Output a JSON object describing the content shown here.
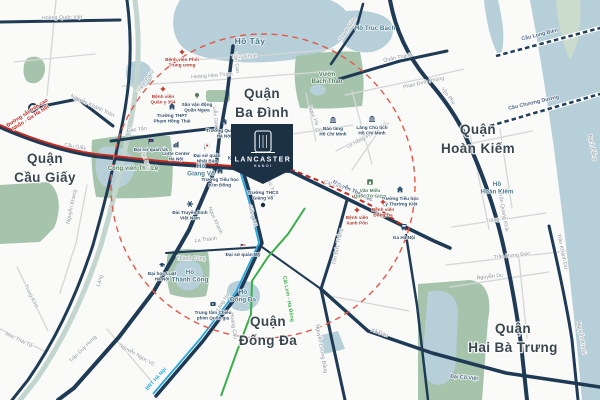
{
  "marker": {
    "title": "LANCASTER",
    "subtitle": "HANOI"
  },
  "colors": {
    "road": "#1e3a55",
    "road_minor": "#d4d7d7",
    "water": "#b6cfd8",
    "park": "#a6c4ac",
    "district_label": "#39474f",
    "metro3": "#c2281e",
    "brt": "#2aa7dd",
    "metro2a": "#3aae49",
    "ring": "#e4584a"
  },
  "districts": [
    {
      "name": "Quận Cầu Giấy",
      "lines": [
        "Quận",
        "Cầu Giấy"
      ],
      "x": 45,
      "y": 163
    },
    {
      "name": "Quận Ba Đình",
      "lines": [
        "Quận",
        "Ba Đình"
      ],
      "x": 262,
      "y": 98
    },
    {
      "name": "Quận Hoàn Kiếm",
      "lines": [
        "Quận",
        "Hoàn Kiếm"
      ],
      "x": 478,
      "y": 134
    },
    {
      "name": "Quận Đống Đa",
      "lines": [
        "Quận",
        "Đống Đa"
      ],
      "x": 268,
      "y": 326
    },
    {
      "name": "Quận Hai Bà Trưng",
      "lines": [
        "Quận",
        "Hai Bà Trưng"
      ],
      "x": 513,
      "y": 333
    }
  ],
  "water_labels": [
    {
      "name": "Hồ Tây",
      "x": 250,
      "y": 44,
      "big": true
    },
    {
      "name": "Hồ Trúc Bạch",
      "x": 375,
      "y": 30
    },
    {
      "name": "Hồ Hoàn Kiếm",
      "lines": [
        "Hồ",
        "Hoàn Kiếm"
      ],
      "x": 497,
      "y": 186
    },
    {
      "name": "Hồ Giảng Võ",
      "lines": [
        "Hồ",
        "Giảng Võ"
      ],
      "x": 201,
      "y": 168
    },
    {
      "name": "Hồ Thành Công",
      "lines": [
        "Hồ",
        "Thành Công"
      ],
      "x": 190,
      "y": 274
    },
    {
      "name": "Hồ Đống Đa",
      "lines": [
        "Hồ",
        "Đống Đa"
      ],
      "x": 243,
      "y": 294
    }
  ],
  "park_labels": [
    {
      "name": "Vườn Bách Thảo",
      "lines": [
        "Vườn",
        "Bách Thảo"
      ],
      "x": 327,
      "y": 76
    },
    {
      "name": "Công viên Thủ Lệ",
      "x": 133,
      "y": 170
    }
  ],
  "streets": [
    {
      "name": "Hoàng Quốc Việt",
      "x": 62,
      "y": 19,
      "rot": -1
    },
    {
      "name": "Nguyễn Khánh Toàn",
      "x": 92,
      "y": 107,
      "rot": 25
    },
    {
      "name": "Cầu Giấy",
      "x": 75,
      "y": 148,
      "rot": 10
    },
    {
      "name": "Đào Tấn",
      "x": 137,
      "y": 131,
      "rot": -7
    },
    {
      "name": "Nguyễn Khang",
      "x": 73,
      "y": 207,
      "rot": -78
    },
    {
      "name": "Láng",
      "x": 101,
      "y": 281,
      "rot": -72
    },
    {
      "name": "Trần Duy Hưng",
      "x": 84,
      "y": 350,
      "rot": -45
    },
    {
      "name": "Nguyễn Ngọc Vũ",
      "x": 136,
      "y": 356,
      "rot": 30
    },
    {
      "name": "Trung Kính",
      "x": 30,
      "y": 297,
      "rot": 64
    },
    {
      "name": "Mạc Thái Tổ",
      "x": 18,
      "y": 341,
      "rot": 26
    },
    {
      "name": "Vành Đai 2",
      "x": 147,
      "y": 82,
      "rot": -55
    },
    {
      "name": "Thụy Khuê",
      "x": 244,
      "y": 58,
      "rot": -3
    },
    {
      "name": "Hoàng Hoa Thám",
      "x": 212,
      "y": 77,
      "rot": -4
    },
    {
      "name": "Văn Cao",
      "x": 235,
      "y": 63,
      "rot": 82
    },
    {
      "name": "Liễu Giai",
      "x": 214,
      "y": 117,
      "rot": 84
    },
    {
      "name": "Ngọc Hà",
      "x": 312,
      "y": 116,
      "rot": 68
    },
    {
      "name": "Đội Cấn",
      "x": 325,
      "y": 131,
      "rot": -7
    },
    {
      "name": "Lê Hồng Phong",
      "x": 364,
      "y": 140,
      "rot": -27
    },
    {
      "name": "Thanh Niên",
      "x": 349,
      "y": 30,
      "rot": -56
    },
    {
      "name": "Quán Thánh",
      "x": 398,
      "y": 59,
      "rot": -11
    },
    {
      "name": "Phan Đình Phùng",
      "x": 424,
      "y": 84,
      "rot": -13
    },
    {
      "name": "Yên Phụ",
      "x": 447,
      "y": 97,
      "rot": 52
    },
    {
      "name": "Kim Mã",
      "x": 237,
      "y": 160,
      "rot": 2,
      "tone": "navy"
    },
    {
      "name": "Núi Trúc",
      "x": 270,
      "y": 188,
      "rot": 74
    },
    {
      "name": "Ngọc Khánh",
      "x": 214,
      "y": 221,
      "rot": 66
    },
    {
      "name": "Vạn Bảo",
      "x": 144,
      "y": 160,
      "rot": 74
    },
    {
      "name": "Giảng Võ",
      "x": 251,
      "y": 216,
      "rot": 76
    },
    {
      "name": "Láng Hạ",
      "x": 224,
      "y": 303,
      "rot": -58
    },
    {
      "name": "La Thành",
      "x": 206,
      "y": 241,
      "rot": -6
    },
    {
      "name": "Thành Công",
      "x": 191,
      "y": 260,
      "rot": 0
    },
    {
      "name": "Hoàng Cầu",
      "x": 232,
      "y": 326,
      "rot": 82
    },
    {
      "name": "Nguyễn Thái Học",
      "x": 352,
      "y": 192,
      "rot": 25,
      "tone": "navy"
    },
    {
      "name": "Cát Linh",
      "x": 333,
      "y": 186,
      "rot": 18
    },
    {
      "name": "Tôn Đức Thắng",
      "x": 339,
      "y": 247,
      "rot": -78
    },
    {
      "name": "Nguyễn Lương Bằng",
      "x": 320,
      "y": 349,
      "rot": 80
    },
    {
      "name": "Xã Đàn",
      "x": 379,
      "y": 334,
      "rot": 20
    },
    {
      "name": "Đại Cồ Việt",
      "x": 464,
      "y": 379,
      "rot": 5,
      "tone": "navy"
    },
    {
      "name": "Tràng Thi",
      "x": 497,
      "y": 221,
      "rot": -8
    },
    {
      "name": "Trần Hưng Đạo",
      "x": 512,
      "y": 257,
      "rot": -6
    },
    {
      "name": "Nguyễn Du",
      "x": 490,
      "y": 278,
      "rot": -6
    },
    {
      "name": "Trần Quang Khải",
      "x": 502,
      "y": 212,
      "rot": 80
    },
    {
      "name": "Trần Khánh Dư",
      "x": 561,
      "y": 252,
      "rot": 78
    },
    {
      "name": "Nguyễn Khoái",
      "x": 580,
      "y": 338,
      "rot": 80
    },
    {
      "name": "Bạch Đằng",
      "x": 591,
      "y": 148,
      "rot": 78
    }
  ],
  "bridges": [
    {
      "name": "Cầu Long Biên",
      "x": 540,
      "y": 36,
      "rot": -14
    },
    {
      "name": "Cầu Chương Dương",
      "x": 534,
      "y": 104,
      "rot": -13
    }
  ],
  "transit": {
    "metro_line_3": {
      "name": "Đường sắt trên cao Nhổn - Ga Hà Nội",
      "color": "#c2281e",
      "label": {
        "lines": [
          "Đường sắt trên cao",
          "Nhổn - Ga Hà Nội"
        ],
        "x": 28,
        "y": 114,
        "rot": -33
      }
    },
    "brt": {
      "name": "BRT Hà Nội",
      "color": "#2aa7dd",
      "label": {
        "x": 157,
        "y": 380,
        "rot": -48
      }
    },
    "metro_line_2a": {
      "name": "Cát Linh - Hà Đông",
      "color": "#3aae49",
      "label": {
        "x": 287,
        "y": 299,
        "rot": 80
      }
    },
    "radius_ring": {
      "color": "#e4584a"
    }
  },
  "landmarks": [
    {
      "type": "hospital",
      "name": "Bệnh viện Phổi Trung ương",
      "x": 182,
      "y": 52,
      "lines": [
        "Bệnh viện Phổi",
        "Trung ương"
      ],
      "lx": 182,
      "ly": 61,
      "tone": "red"
    },
    {
      "type": "hospital",
      "name": "Bệnh viện Quân y 354",
      "x": 163,
      "y": 89,
      "lines": [
        "Bệnh viện",
        "Quân y 354"
      ],
      "lx": 163,
      "ly": 98,
      "tone": "red"
    },
    {
      "type": "stadium",
      "name": "Sân vận động Quần Ngựa",
      "x": 197,
      "y": 96,
      "lines": [
        "Sân vận động",
        "Quần Ngựa"
      ],
      "lx": 197,
      "ly": 106
    },
    {
      "type": "school",
      "name": "Trường THPT Phạm Hồng Thái",
      "x": 172,
      "y": 107,
      "lines": [
        "Trường THPT",
        "Phạm Hồng Thái"
      ],
      "lx": 172,
      "ly": 117
    },
    {
      "type": "school",
      "name": "Trường Quốc tế Hà Nội",
      "x": 224,
      "y": 122,
      "lines": [
        "Trường Quốc tế",
        "Hà Nội"
      ],
      "lx": 224,
      "ly": 132
    },
    {
      "type": "flag-au",
      "name": "Đại sứ quán Úc",
      "x": 151,
      "y": 142,
      "lines": [
        "Đại sứ quán Úc"
      ],
      "lx": 151,
      "ly": 151
    },
    {
      "type": "bars",
      "name": "Lotte Center Hà Nội",
      "x": 176,
      "y": 145,
      "lines": [
        "Lotte Center",
        "Hà Nội"
      ],
      "lx": 176,
      "ly": 155
    },
    {
      "type": "flag-jp",
      "name": "Đại sứ quán Nhật Bản",
      "x": 207,
      "y": 147,
      "lines": [
        "Đại sứ quán",
        "Nhật Bản"
      ],
      "lx": 207,
      "ly": 157
    },
    {
      "type": "museum",
      "name": "Bảo tàng Hồ Chí Minh",
      "x": 333,
      "y": 120,
      "lines": [
        "Bảo tàng",
        "Hồ Chí Minh"
      ],
      "lx": 333,
      "ly": 130
    },
    {
      "type": "museum",
      "name": "Lăng Chủ tịch Hồ Chí Minh",
      "x": 372,
      "y": 119,
      "lines": [
        "Lăng Chủ tịch",
        "Hồ Chí Minh"
      ],
      "lx": 372,
      "ly": 129
    },
    {
      "type": "tv",
      "name": "Đài Truyền hình Việt Nam",
      "x": 190,
      "y": 204,
      "lines": [
        "Đài Truyền hình",
        "Việt Nam"
      ],
      "lx": 190,
      "ly": 214
    },
    {
      "type": "school",
      "name": "Trường Tiểu học Kim Đồng",
      "x": 220,
      "y": 171,
      "lines": [
        "Trường Tiểu học",
        "Kim Đồng"
      ],
      "lx": 220,
      "ly": 181
    },
    {
      "type": "none",
      "name": "Trường THCS Giảng Võ",
      "x": 263,
      "y": 190,
      "lines": [
        "Trường THCS",
        "Giảng Võ"
      ],
      "lx": 263,
      "ly": 194
    },
    {
      "type": "flag-us",
      "name": "Đại sứ quán Mỹ",
      "x": 243,
      "y": 247,
      "lines": [
        "Đại sứ quán Mỹ"
      ],
      "lx": 243,
      "ly": 256
    },
    {
      "type": "university",
      "name": "Đại học Luật Hà Nội",
      "x": 162,
      "y": 265,
      "lines": [
        "Đại học Luật",
        "Hà Nội"
      ],
      "lx": 162,
      "ly": 275
    },
    {
      "type": "cinema",
      "name": "Trung tâm Chiếu phim Quốc gia",
      "x": 213,
      "y": 304,
      "lines": [
        "Trung tâm Chiếu",
        "phim Quốc gia"
      ],
      "lx": 213,
      "ly": 314
    },
    {
      "type": "temple",
      "name": "Văn Miếu Quốc Tử Giám",
      "x": 370,
      "y": 182,
      "lines": [
        "Văn Miếu",
        "Quốc Tử Giám"
      ],
      "lx": 370,
      "ly": 192,
      "tone": "green"
    },
    {
      "type": "school",
      "name": "Trường Tiểu học Lý Thường Kiệt",
      "x": 400,
      "y": 190,
      "lines": [
        "Trường Tiểu học",
        "Lý Thường Kiệt"
      ],
      "lx": 400,
      "ly": 200
    },
    {
      "type": "hospital",
      "name": "Bệnh viện Đống Đa",
      "x": 383,
      "y": 202,
      "lines": [
        "Bệnh viện",
        "Đống Đa"
      ],
      "lx": 383,
      "ly": 211,
      "tone": "red"
    },
    {
      "type": "hospital",
      "name": "Bệnh viện Xanh Pôn",
      "x": 357,
      "y": 210,
      "lines": [
        "Bệnh viện",
        "Xanh Pôn"
      ],
      "lx": 357,
      "ly": 219,
      "tone": "red"
    },
    {
      "type": "train",
      "name": "Ga Hà Nội",
      "x": 404,
      "y": 227,
      "lines": [
        "Ga Hà Nội"
      ],
      "lx": 404,
      "ly": 239
    }
  ]
}
